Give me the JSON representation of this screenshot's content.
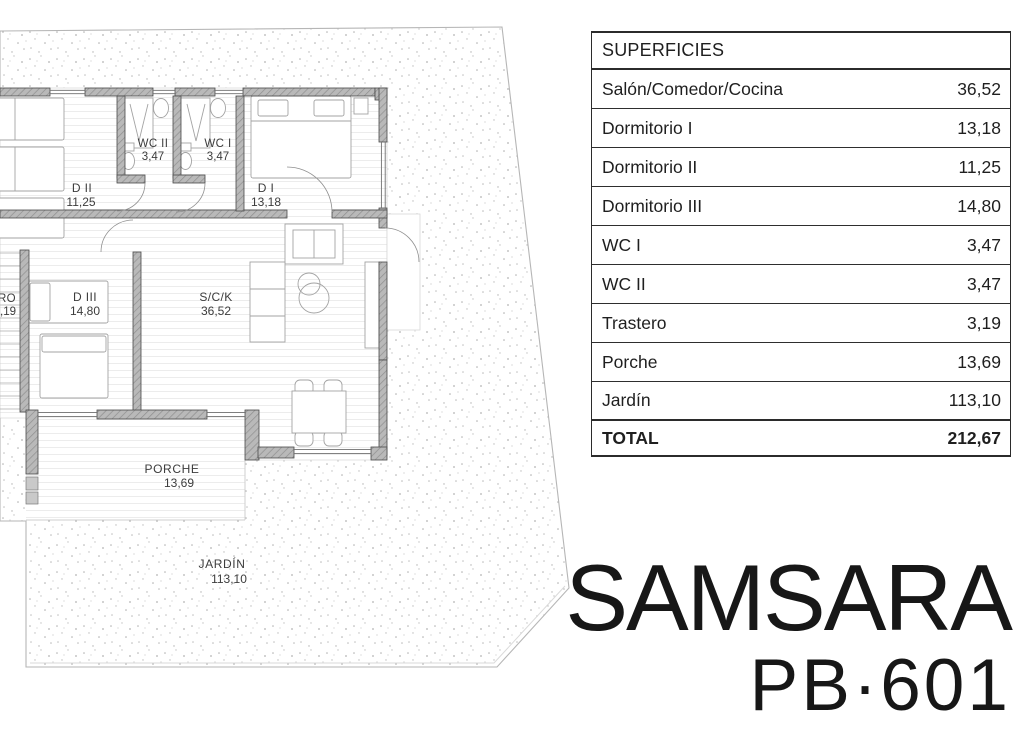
{
  "plan": {
    "rooms": [
      {
        "name": "WC II",
        "area": "3,47"
      },
      {
        "name": "WC I",
        "area": "3,47"
      },
      {
        "name": "D II",
        "area": "11,25"
      },
      {
        "name": "D I",
        "area": "13,18"
      },
      {
        "name": "D III",
        "area": "14,80"
      },
      {
        "name": "S/C/K",
        "area": "36,52"
      },
      {
        "name": "PORCHE",
        "area": "13,69"
      },
      {
        "name": "JARDÍN",
        "area": "113,10"
      },
      {
        "name": "TRO",
        "area": ",19"
      }
    ]
  },
  "table": {
    "header": "SUPERFICIES",
    "rows": [
      {
        "label": "Salón/Comedor/Cocina",
        "value": "36,52"
      },
      {
        "label": "Dormitorio I",
        "value": "13,18"
      },
      {
        "label": "Dormitorio II",
        "value": "11,25"
      },
      {
        "label": "Dormitorio III",
        "value": "14,80"
      },
      {
        "label": "WC I",
        "value": "3,47"
      },
      {
        "label": "WC II",
        "value": "3,47"
      },
      {
        "label": "Trastero",
        "value": "3,19"
      },
      {
        "label": "Porche",
        "value": "13,69"
      },
      {
        "label": "Jardín",
        "value": "113,10"
      }
    ],
    "total": {
      "label": "TOTAL",
      "value": "212,67"
    }
  },
  "branding": {
    "name": "SAMSARA",
    "model": "PB·601"
  },
  "colors": {
    "wall_gray": "#b9b9b9",
    "wall_hatch": "#8f8f8f",
    "border_dark": "#2b2b2b",
    "stipple_dot": "#b0b0b0",
    "text_dark": "#1f1f1f"
  }
}
